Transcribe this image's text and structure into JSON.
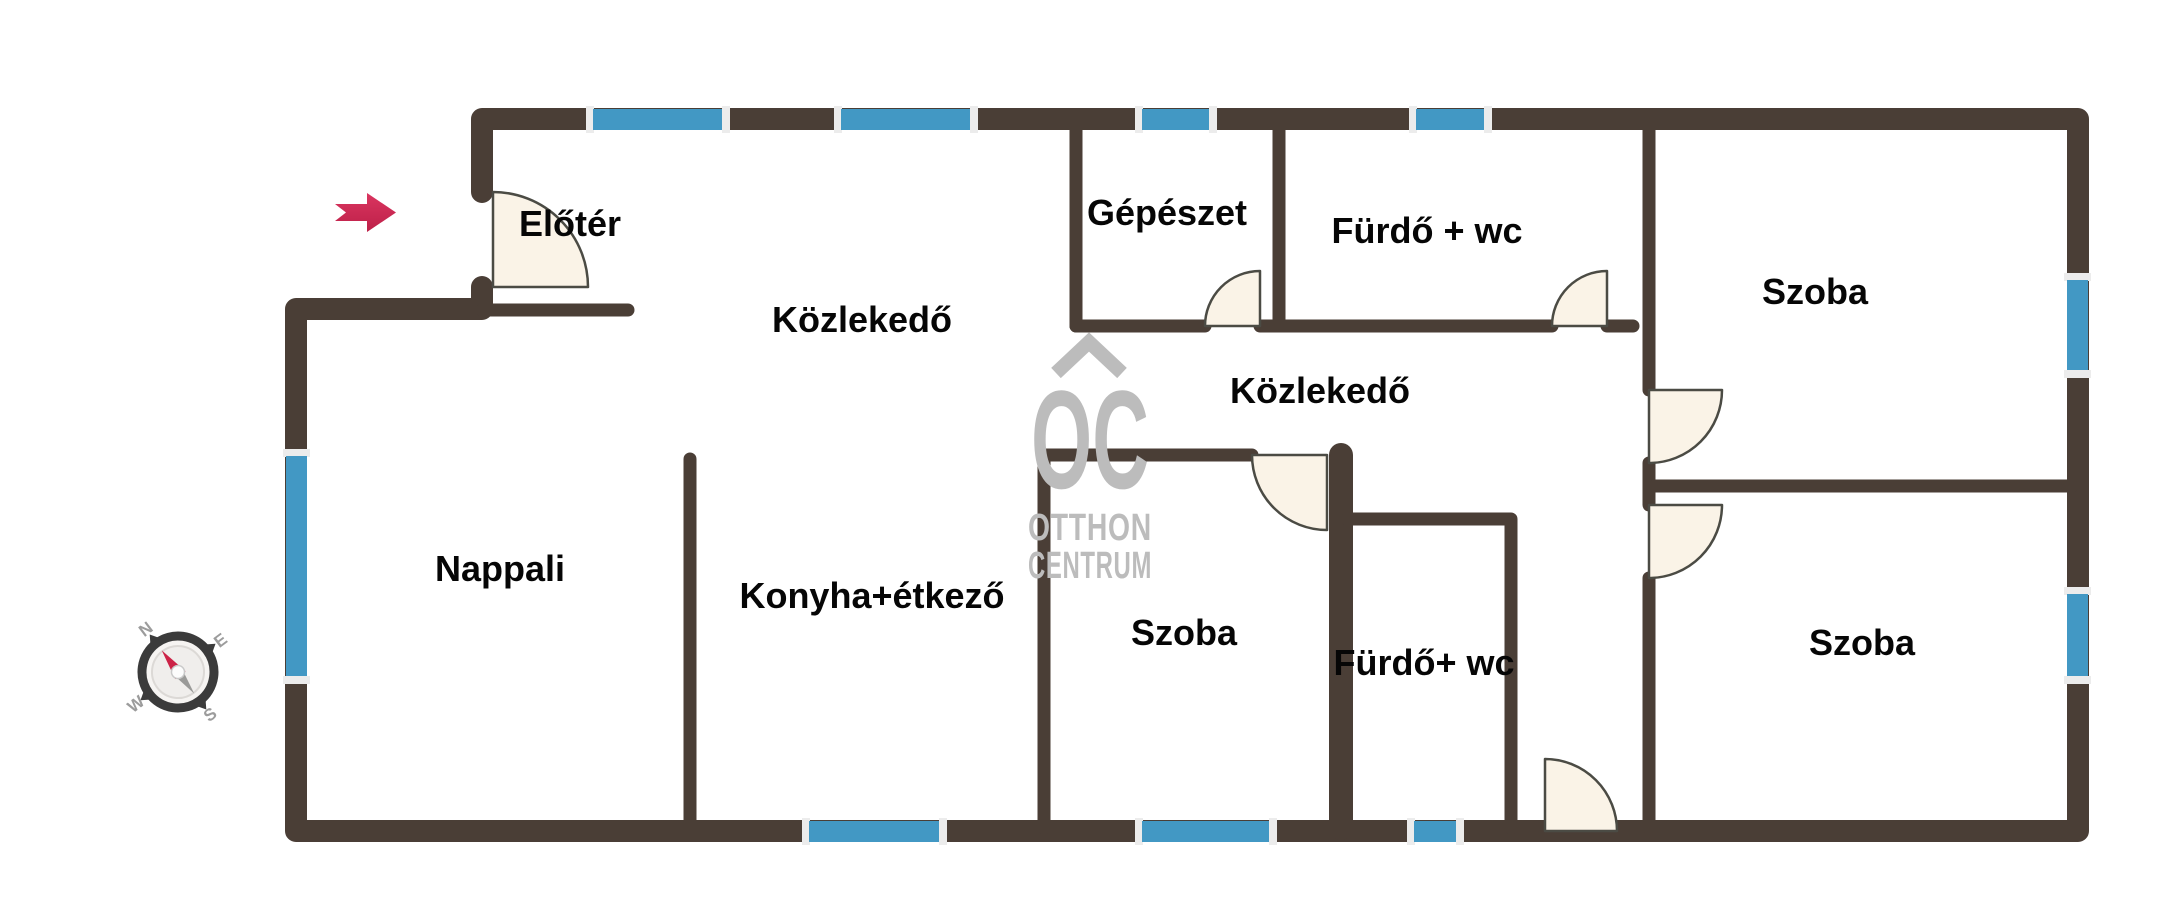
{
  "rooms": [
    {
      "id": "eloter",
      "label": "Előtér"
    },
    {
      "id": "kozlekedo-felso",
      "label": "Közlekedő"
    },
    {
      "id": "gepeszet",
      "label": "Gépészet"
    },
    {
      "id": "furdo-wc-felso",
      "label": "Fürdő + wc"
    },
    {
      "id": "szoba-jobb-felso",
      "label": "Szoba"
    },
    {
      "id": "kozlekedo-kozepso",
      "label": "Közlekedő"
    },
    {
      "id": "nappali",
      "label": "Nappali"
    },
    {
      "id": "konyha-etkezo",
      "label": "Konyha+étkező"
    },
    {
      "id": "szoba-kozepso",
      "label": "Szoba"
    },
    {
      "id": "furdo-wc-also",
      "label": "Fürdő+ wc"
    },
    {
      "id": "szoba-jobb-also",
      "label": "Szoba"
    }
  ],
  "watermark": {
    "logo": "OC",
    "line1": "OTTHON",
    "line2": "CENTRUM"
  },
  "compass": {
    "north": "N",
    "east": "E",
    "south": "S",
    "west": "W"
  },
  "colors": {
    "wall": "#4a3e36",
    "window": "#4298c4",
    "window_cap": "#ececec",
    "door_fill": "#faf3e7",
    "door_outline": "#4b4b44",
    "label": "#060606",
    "watermark": "#bcbcbc",
    "compass_dark": "#3b3b3b",
    "compass_letters": "#9c9c9c",
    "needle_north": "#cc2347",
    "needle_south": "#9a9a98",
    "arrow_light": "#da3560",
    "arrow_dark": "#bd2048"
  }
}
